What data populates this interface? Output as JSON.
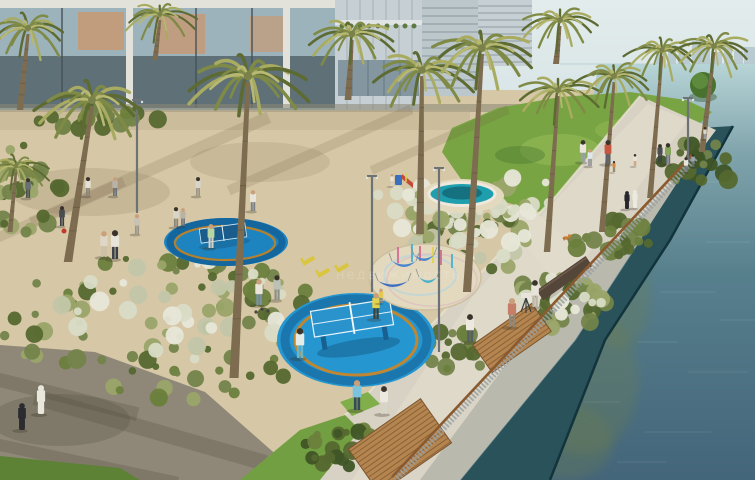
{
  "meta": {
    "type": "architectural-rendering",
    "description": "Aerial rendering of a landscaped waterfront park: palm trees, blue circular table-tennis pads, kids splash pool, hammock playground, lawns, and a canal-side promenade with railing",
    "watermark": "недвижимость"
  },
  "palette": {
    "sky": "#d7e4e6",
    "skyTop": "#e3ecec",
    "skyline": "#b4c5ce",
    "horizon": "#c6d8da",
    "waterTop": "#b7d4d6",
    "waterMid": "#7fa3ab",
    "waterLow": "#57808d",
    "waterDeep": "#44657a",
    "algae": "#6e7e4b",
    "seawall": "#2a525b",
    "seawallEdge": "#13343c",
    "wallTop": "#a8bcb9",
    "ledge": "#bab9ae",
    "walk": "#d8d2c4",
    "walkLight": "#e1dbcc",
    "curb": "#e9e2cf",
    "sand": "#d6c8a6",
    "sandShade": "#bfae8d",
    "shade": "#8a8672",
    "gravel": "#8f8878",
    "gravelShadow": "#575043",
    "lawn": "#79a443",
    "lawnLight": "#90b854",
    "lawnDark": "#4f7a33",
    "grassStrip": "#5d8236",
    "treeGreen": "#49722f",
    "treeHi": "#639040",
    "shrubDark": "#55682f",
    "shrubMid": "#73844a",
    "shrubLight": "#9aa569",
    "plume": "#d9dcc6",
    "plumeWhite": "#e7e7d8",
    "hedge": "#3f5526",
    "padBlue": "#2596cf",
    "padBlueDark": "#1a76ad",
    "padBlueA": "#1d84c0",
    "padBandA": "#14669f",
    "ringOrange": "#c08631",
    "ringOrangeA": "#b5812f",
    "tableBlue": "#2a93cc",
    "tableNavy": "#1a5c8c",
    "tableLeg": "#17608f",
    "lineWhite": "#e8f5fb",
    "tableShadow": "#0f4468",
    "poolTeal": "#1f9fae",
    "poolDeep": "#15717f",
    "poolRim": "#eee9dc",
    "padSand": "#e3d9bf",
    "padSandEdge": "#cdbf9f",
    "paintBlue": "#bcd4da",
    "paintPink": "#d8b8c2",
    "deckWood": "#b5854f",
    "deckLine": "#8a6238",
    "deckEdge": "#7a5530",
    "railWood": "#8a5a2e",
    "railSlat": "#9aa1a3",
    "benchWood": "#55463a",
    "benchHi": "#6f5c4c",
    "trunk": "#7d6c50",
    "trunkRing": "#63543e",
    "frond1": "#5d6b33",
    "frond2": "#7e8a45",
    "frond3": "#a8ab60",
    "frondHi": "#b7b873",
    "tuft": "#7a814a",
    "lamp": "#6d7275",
    "skin": "#caa07a",
    "shadow": "#3a3428",
    "glassUp": "#9db3bb",
    "glassLow": "#5f7077",
    "mullion": "#e2e2da",
    "frameDark": "#46525a",
    "curtain": "#cd9468",
    "towerB": "#c6cfd3",
    "towerBline": "#b0babf",
    "towerC": "#bcc7cc",
    "towerCline": "#9aa7ab",
    "chairYellow": "#d9c53e",
    "dogOrange": "#c87f3a",
    "bagRed": "#c0392b",
    "telescope": "#3a3f42",
    "telescopeBox": "#e8e4da"
  },
  "scene": {
    "skylineTowers": [
      [
        656,
        10,
        13
      ],
      [
        668,
        8,
        19
      ],
      [
        678,
        12,
        10
      ],
      [
        692,
        9,
        23
      ],
      [
        703,
        7,
        15
      ],
      [
        712,
        10,
        12
      ],
      [
        724,
        8,
        21
      ],
      [
        734,
        9,
        13
      ],
      [
        744,
        11,
        17
      ],
      [
        699,
        6,
        28
      ]
    ],
    "algae": [
      [
        583,
        380,
        55,
        75
      ],
      [
        620,
        300,
        30,
        48
      ],
      [
        565,
        442,
        48,
        38
      ],
      [
        612,
        252,
        22,
        30
      ]
    ],
    "ripples": [
      [
        650,
        140,
        40
      ],
      [
        700,
        182,
        50
      ],
      [
        622,
        262,
        34
      ],
      [
        688,
        292,
        55
      ],
      [
        658,
        342,
        40
      ],
      [
        718,
        372,
        60
      ],
      [
        602,
        402,
        36
      ],
      [
        678,
        432,
        66
      ],
      [
        728,
        242,
        44
      ],
      [
        642,
        462,
        50
      ],
      [
        740,
        320,
        40
      ],
      [
        700,
        120,
        30
      ]
    ],
    "palms": [
      [
        92,
        102,
        1.25,
        68,
        262
      ],
      [
        248,
        78,
        1.35,
        234,
        378
      ],
      [
        28,
        30,
        0.95,
        20,
        110
      ],
      [
        160,
        16,
        0.8,
        155,
        60
      ],
      [
        352,
        36,
        1.0,
        348,
        100
      ],
      [
        422,
        72,
        1.15,
        420,
        234
      ],
      [
        482,
        50,
        1.2,
        467,
        292
      ],
      [
        560,
        22,
        0.9,
        556,
        64
      ],
      [
        558,
        92,
        0.95,
        547,
        252
      ],
      [
        614,
        78,
        0.9,
        602,
        232
      ],
      [
        662,
        52,
        0.85,
        650,
        198
      ],
      [
        714,
        48,
        0.9,
        702,
        152
      ],
      [
        16,
        168,
        0.75,
        10,
        232
      ]
    ],
    "clusters": [
      {
        "c": [
          165,
          330,
          165,
          75
        ],
        "n": 90,
        "cols": [
          "#55682f",
          "#73844a",
          "#9aa569",
          "#6b7f3c"
        ]
      },
      {
        "c": [
          200,
          308,
          140,
          55
        ],
        "n": 34,
        "cols": [
          "#e7e7d8",
          "#d9dcc6",
          "#c2c6a8"
        ]
      },
      {
        "c": [
          472,
          240,
          58,
          36
        ],
        "n": 40,
        "cols": [
          "#55682f",
          "#73844a",
          "#9aa569",
          "#c2c6a8"
        ]
      },
      {
        "c": [
          558,
          302,
          52,
          28
        ],
        "n": 30,
        "cols": [
          "#55682f",
          "#73844a",
          "#9aa569"
        ]
      },
      {
        "c": [
          612,
          238,
          40,
          24
        ],
        "n": 22,
        "cols": [
          "#55682f",
          "#73844a",
          "#6b7f3c"
        ]
      },
      {
        "c": [
          480,
          232,
          50,
          30
        ],
        "n": 16,
        "cols": [
          "#e7e7d8",
          "#d9dcc6"
        ]
      },
      {
        "c": [
          568,
          296,
          45,
          24
        ],
        "n": 12,
        "cols": [
          "#e7e7d8",
          "#d9dcc6"
        ]
      },
      {
        "c": [
          28,
          190,
          38,
          48
        ],
        "n": 26,
        "cols": [
          "#55682f",
          "#73844a",
          "#9aa569"
        ]
      },
      {
        "c": [
          412,
          207,
          40,
          24
        ],
        "n": 18,
        "cols": [
          "#d9dcc6",
          "#9aa569",
          "#e7e7d8"
        ]
      },
      {
        "c": [
          516,
          196,
          40,
          22
        ],
        "n": 18,
        "cols": [
          "#e7e7d8",
          "#9aa569",
          "#d9dcc6"
        ]
      },
      {
        "c": [
          345,
          448,
          48,
          22
        ],
        "n": 24,
        "cols": [
          "#3f5526",
          "#55682f",
          "#6b7f3c"
        ]
      },
      {
        "c": [
          700,
          165,
          40,
          24
        ],
        "n": 20,
        "cols": [
          "#3f5526",
          "#55682f",
          "#73844a"
        ]
      },
      {
        "c": [
          95,
          116,
          72,
          14
        ],
        "n": 22,
        "cols": [
          "#55682f",
          "#73844a",
          "#6b7f3c"
        ]
      },
      {
        "c": [
          452,
          352,
          40,
          22
        ],
        "n": 16,
        "cols": [
          "#55682f",
          "#73844a",
          "#6b7f3c"
        ]
      }
    ],
    "hammocks": [
      [
        404,
        261,
        24,
        "#4a84cf"
      ],
      [
        424,
        255,
        20,
        "#4a84cf"
      ],
      [
        393,
        281,
        30,
        "#3f6fc0"
      ],
      [
        428,
        277,
        18,
        "#49b0c9"
      ]
    ],
    "poles": [
      [
        398,
        247,
        16,
        "#d76a92"
      ],
      [
        412,
        244,
        18,
        "#49b0c9"
      ],
      [
        420,
        246,
        15,
        "#d76a92"
      ],
      [
        433,
        247,
        16,
        "#e0d44a"
      ],
      [
        441,
        250,
        15,
        "#d76a92"
      ],
      [
        452,
        254,
        14,
        "#49b0c9"
      ]
    ],
    "chairs": [
      [
        303,
        264
      ],
      [
        318,
        276
      ],
      [
        337,
        271
      ]
    ],
    "lamps": [
      [
        439,
        168,
        352
      ],
      [
        372,
        176,
        292
      ],
      [
        137,
        100,
        213
      ],
      [
        688,
        98,
        162
      ]
    ],
    "people": [
      [
        28,
        198,
        20,
        "#6a6f74",
        "#4a4f54",
        "#3a332c"
      ],
      [
        88,
        196,
        19,
        "#e4e0d4",
        "#8a8478",
        "#3a332c"
      ],
      [
        115,
        196,
        19,
        "#b9b3a7",
        "#6a7077",
        "#caa07a"
      ],
      [
        198,
        196,
        19,
        "#d8d4c8",
        "#9a948a",
        "#3a332c"
      ],
      [
        253,
        211,
        21,
        "#e8e4d8",
        "#7a8088",
        "#caa07a"
      ],
      [
        62,
        226,
        20,
        "#4a4e52",
        "#3c4044",
        "#3a332c"
      ],
      [
        104,
        257,
        26,
        "#ded6c6",
        "#cabfa8",
        "#caa07a"
      ],
      [
        115,
        259,
        29,
        "#e8e4d8",
        "#3a4148",
        "#3a332c"
      ],
      [
        137,
        234,
        20,
        "#c9c2b4",
        "#9a948a",
        "#caa07a"
      ],
      [
        176,
        227,
        20,
        "#d9d5c9",
        "#8a8478",
        "#3a332c"
      ],
      [
        183,
        226,
        18,
        "#b9b3a5",
        "#6a7077",
        "#caa07a"
      ],
      [
        211,
        248,
        24,
        "#b7d6a4",
        "#d6d2c6",
        "#caa07a"
      ],
      [
        259,
        305,
        26,
        "#e9e5d9",
        "#7b94a9",
        "#caa07a"
      ],
      [
        277,
        300,
        25,
        "#bcc1b6",
        "#8b9086",
        "#3a332c"
      ],
      [
        300,
        358,
        30,
        "#e3ece7",
        "#6ab6c8",
        "#3a332c"
      ],
      [
        376,
        319,
        26,
        "#e3d24d",
        "#3c4038",
        "#caa07a"
      ],
      [
        381,
        303,
        16,
        "#e5c94e",
        "#8a8578",
        "#caa07a",
        "sit"
      ],
      [
        392,
        186,
        12,
        "#e9e5da",
        "#d9d5c9",
        "#caa07a"
      ],
      [
        470,
        342,
        28,
        "#eee9df",
        "#565e66",
        "#3a332c"
      ],
      [
        512,
        327,
        29,
        "#c57f68",
        "#8f8878",
        "#caa07a"
      ],
      [
        535,
        307,
        27,
        "#e7e3d8",
        "#bdb7a9",
        "#3a332c"
      ],
      [
        357,
        410,
        30,
        "#7cc3de",
        "#39495a",
        "#caa07a"
      ],
      [
        384,
        414,
        28,
        "#ece8de",
        "#d9d5c9",
        "#3a332c"
      ],
      [
        22,
        430,
        27,
        "#2b2b30",
        "#2b2b30",
        "#2b2b30"
      ],
      [
        41,
        414,
        29,
        "#e9e6dc",
        "#e9e6dc",
        "#e9e6dc"
      ],
      [
        583,
        162,
        22,
        "#e9e5da",
        "#9aa0a8",
        "#3a332c"
      ],
      [
        590,
        166,
        17,
        "#dfe6ec",
        "#8a8f95",
        "#caa07a"
      ],
      [
        608,
        164,
        24,
        "#c6563e",
        "#5a6168",
        "#3a332c"
      ],
      [
        635,
        166,
        12,
        "#e8e4d8",
        "#caa07a",
        "#3a332c"
      ],
      [
        614,
        172,
        11,
        "#d8893a",
        "#8a7a5a",
        "#3a332c"
      ],
      [
        668,
        164,
        21,
        "#88a45c",
        "#6a7077",
        "#3a332c"
      ],
      [
        660,
        162,
        18,
        "#4a4e52",
        "#3c4044",
        "#3a332c"
      ],
      [
        705,
        139,
        12,
        "#d9d5c9",
        "#9aa0a8",
        "#3a332c"
      ],
      [
        686,
        172,
        15,
        "#e8e4da",
        "#7a8088",
        "#3a332c"
      ],
      [
        693,
        167,
        13,
        "#9aa4ae",
        "#6a7077",
        "#3a332c"
      ],
      [
        627,
        209,
        18,
        "#26262b",
        "#26262b",
        "#26262b"
      ],
      [
        635,
        208,
        18,
        "#eceadf",
        "#eceadf",
        "#eceadf"
      ]
    ],
    "balls": [
      [
        262,
        309
      ],
      [
        268,
        311
      ],
      [
        256,
        312
      ]
    ],
    "dog": [
      566,
      238
    ],
    "bag": [
      64,
      231
    ]
  }
}
